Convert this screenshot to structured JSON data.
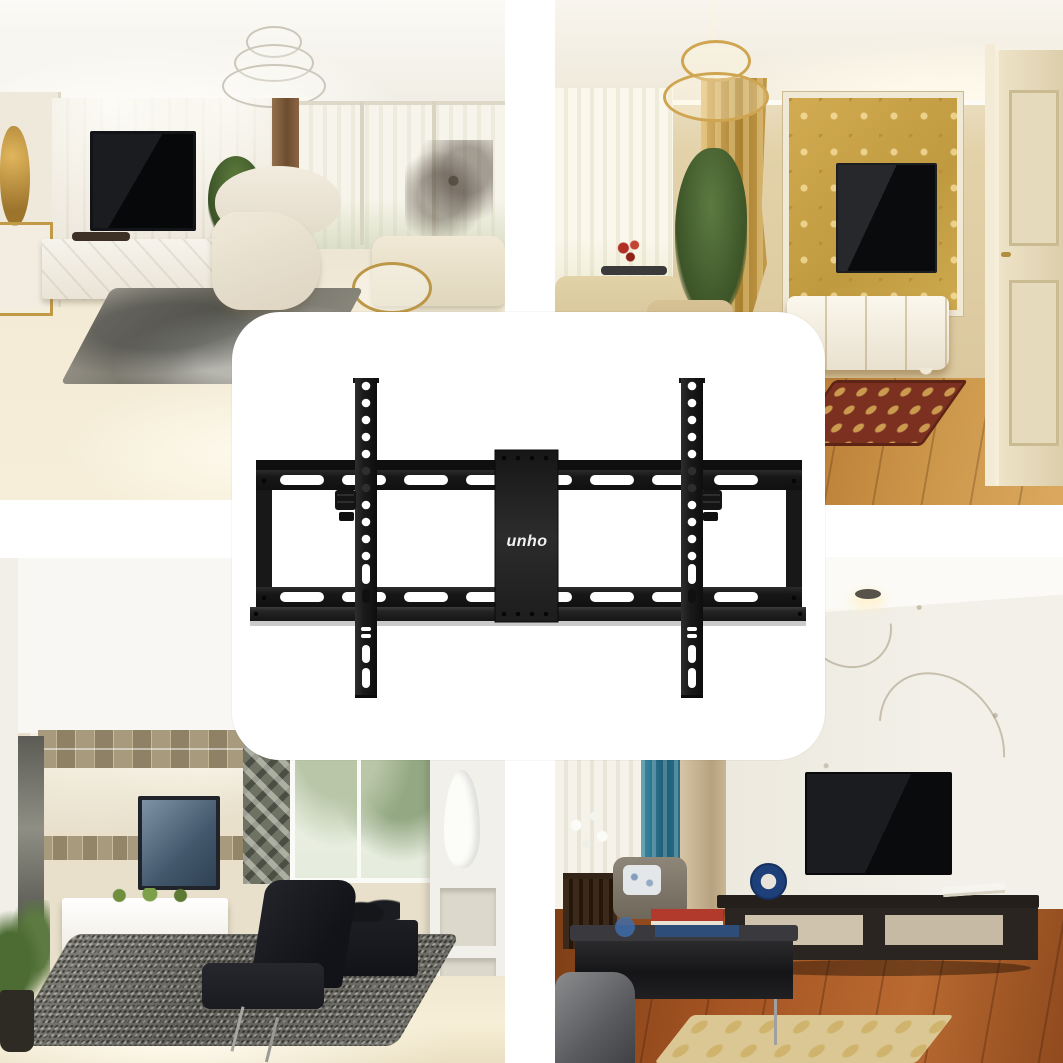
{
  "page": {
    "background_color": "#ffffff",
    "kind": "product listing collage: four living-room photos around a centered product card"
  },
  "product_card": {
    "background_color": "#ffffff",
    "brand_logo": "unho",
    "product": "tilting TV wall mount bracket",
    "bracket_color": "#1c1c1c",
    "logo_color": "#f2f2f2"
  },
  "photos": {
    "top_left": {
      "label": "modern cream living room with wall-mounted black TV, white marble media cabinet, white lounge chair, silver chandelier and grey rug",
      "colors": [
        "#f2efe7",
        "#e9e2d4",
        "#0c0d0f",
        "#8d8b80"
      ]
    },
    "top_right": {
      "label": "classic living room with gold damask TV feature wall, gold chandelier and curtain, white ornate cabinet, cream panel door and wood floor",
      "colors": [
        "#c9a247",
        "#b5762f",
        "#f0e9d6",
        "#0b0c0e"
      ]
    },
    "bottom_left": {
      "label": "contemporary living room with mosaic tile TV wall, cove-lit angled ceiling, white floating cabinet, grey shag rug and black lounge chair",
      "colors": [
        "#e8e0cb",
        "#a89a7c",
        "#6f6e66",
        "#1b1c20"
      ]
    },
    "bottom_right": {
      "label": "living room with white floral-bird wallpaper, large black TV, long dark media cabinet, teal curtain, dark coffee table and red-brown wood floor",
      "colors": [
        "#eeebe2",
        "#9a4d20",
        "#2f7e97",
        "#2a2520"
      ]
    }
  }
}
